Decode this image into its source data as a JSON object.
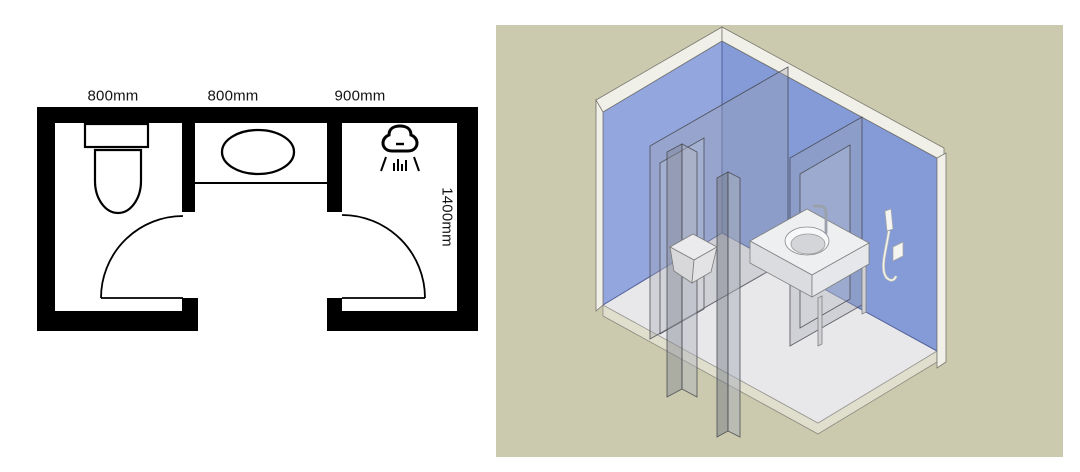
{
  "page": {
    "background": "#ffffff"
  },
  "floor_plan": {
    "section_labels": [
      {
        "label": "800mm",
        "fixture": "toilet"
      },
      {
        "label": "800mm",
        "fixture": "sink"
      },
      {
        "label": "900mm",
        "fixture": "shower"
      }
    ],
    "depth_label": "1400mm",
    "wall_color": "#000000",
    "icons": [
      "toilet-symbol",
      "sink-oval-symbol",
      "shower-head-icon",
      "door-swing-arc"
    ]
  },
  "iso_view": {
    "background_color": "#cccaae",
    "left_wall_color": "#93a6de",
    "right_wall_color": "#849bd8",
    "floor_color": "#e8e8ea",
    "trim_color": "#f0efe8",
    "partition_color": "rgba(158,163,173,0.32)",
    "fixtures": [
      "toilet-box",
      "vanity-counter",
      "round-basin",
      "faucet",
      "handheld-shower-set"
    ]
  }
}
